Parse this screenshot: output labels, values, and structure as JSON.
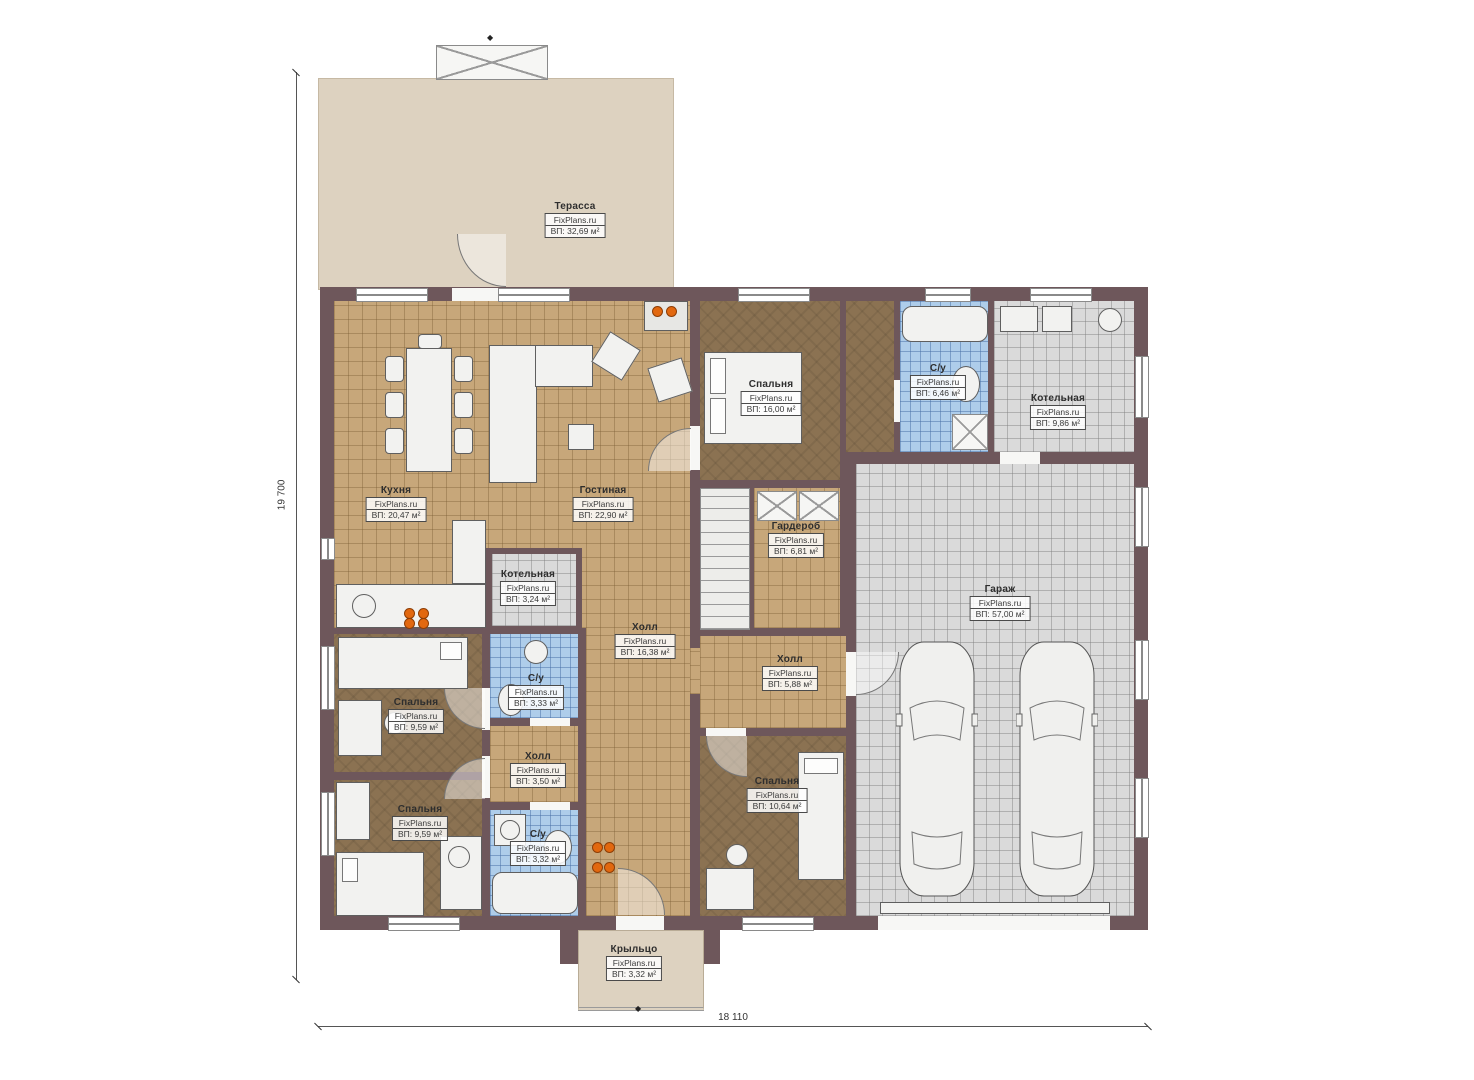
{
  "plan_title": "floor-plan",
  "dimensions": {
    "left": "19 700",
    "bottom": "18 110"
  },
  "rooms": [
    {
      "key": "terrace",
      "name": "Терасса",
      "brand": "FixPlans.ru",
      "area": "ВП: 32,69 м²"
    },
    {
      "key": "kitchen",
      "name": "Кухня",
      "brand": "FixPlans.ru",
      "area": "ВП: 20,47 м²"
    },
    {
      "key": "living-room",
      "name": "Гостиная",
      "brand": "FixPlans.ru",
      "area": "ВП: 22,90 м²"
    },
    {
      "key": "bedroom-top",
      "name": "Спальня",
      "brand": "FixPlans.ru",
      "area": "ВП: 16,00 м²"
    },
    {
      "key": "bathroom-top",
      "name": "С/у",
      "brand": "FixPlans.ru",
      "area": "ВП: 6,46 м²"
    },
    {
      "key": "boiler-top",
      "name": "Котельная",
      "brand": "FixPlans.ru",
      "area": "ВП: 9,86 м²"
    },
    {
      "key": "wardrobe",
      "name": "Гардероб",
      "brand": "FixPlans.ru",
      "area": "ВП: 6,81 м²"
    },
    {
      "key": "boiler-small",
      "name": "Котельная",
      "brand": "FixPlans.ru",
      "area": "ВП: 3,24 м²"
    },
    {
      "key": "hall-main",
      "name": "Холл",
      "brand": "FixPlans.ru",
      "area": "ВП: 16,38 м²"
    },
    {
      "key": "garage",
      "name": "Гараж",
      "brand": "FixPlans.ru",
      "area": "ВП: 57,00 м²"
    },
    {
      "key": "bathroom-mid",
      "name": "С/у",
      "brand": "FixPlans.ru",
      "area": "ВП: 3,33 м²"
    },
    {
      "key": "bedroom-left-upper",
      "name": "Спальня",
      "brand": "FixPlans.ru",
      "area": "ВП: 9,59 м²"
    },
    {
      "key": "hall-right",
      "name": "Холл",
      "brand": "FixPlans.ru",
      "area": "ВП: 5,88 м²"
    },
    {
      "key": "hall-small",
      "name": "Холл",
      "brand": "FixPlans.ru",
      "area": "ВП: 3,50 м²"
    },
    {
      "key": "bedroom-left-lower",
      "name": "Спальня",
      "brand": "FixPlans.ru",
      "area": "ВП: 9,59 м²"
    },
    {
      "key": "bathroom-lower",
      "name": "С/у",
      "brand": "FixPlans.ru",
      "area": "ВП: 3,32 м²"
    },
    {
      "key": "bedroom-bottom",
      "name": "Спальня",
      "brand": "FixPlans.ru",
      "area": "ВП: 10,64 м²"
    },
    {
      "key": "porch",
      "name": "Крыльцо",
      "brand": "FixPlans.ru",
      "area": "ВП: 3,32 м²"
    }
  ],
  "colors": {
    "wall": "#6e575b",
    "tile_tan": "#c7a77a",
    "tile_blue": "#aecdea",
    "tile_gray": "#dadada",
    "wood_brown": "#8b7252",
    "terrace": "#ddd2c0",
    "accent_burner": "#e2680f"
  }
}
